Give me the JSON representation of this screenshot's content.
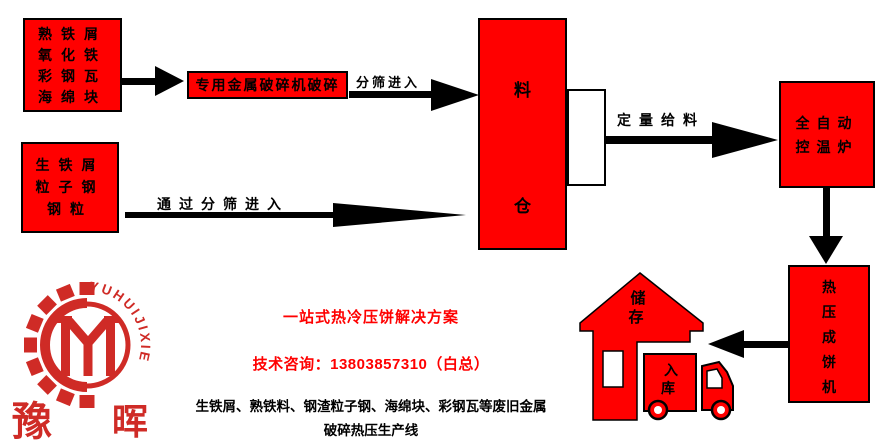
{
  "colors": {
    "box_red": "#ff0000",
    "logo_red": "#cf2b26",
    "accent_text_red": "#ff0000",
    "line_black": "#000000"
  },
  "flow": {
    "scrap_box_top": {
      "lines": [
        "熟铁屑",
        "氧化铁",
        "彩钢瓦",
        "海绵块"
      ]
    },
    "crusher_box": {
      "label": "专用金属破碎机破碎"
    },
    "sieve_label": "分筛进入",
    "scrap_box_bottom": {
      "lines": [
        "生铁屑",
        "粒子钢",
        "钢粒"
      ]
    },
    "bypass_label": "通过分筛进入",
    "silo": {
      "char_top": "料",
      "char_bottom": "仓"
    },
    "feed_label": "定量给料",
    "furnace": {
      "lines": [
        "全自动",
        "控温炉"
      ]
    },
    "press": {
      "chars": [
        "热",
        "压",
        "成",
        "饼",
        "机"
      ]
    },
    "house": {
      "chars": [
        "储",
        "存"
      ]
    },
    "truck": {
      "chars": [
        "入",
        "库"
      ]
    }
  },
  "footer": {
    "slogan": "一站式热冷压饼解决方案",
    "contact": "技术咨询：13803857310（白总）",
    "desc_line1": "生铁屑、熟铁料、钢渣粒子钢、海绵块、彩钢瓦等废旧金属",
    "desc_line2": "破碎热压生产线"
  },
  "logo": {
    "ring_text": "YUHUIJIXIE",
    "char_left": "豫",
    "char_right": "晖"
  }
}
